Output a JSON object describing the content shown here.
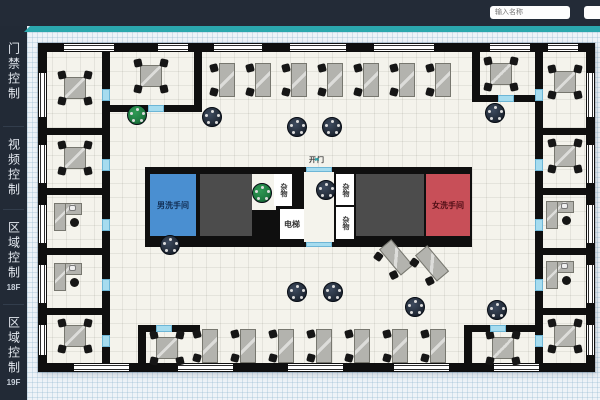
{
  "header": {
    "inputs": [
      {
        "name": "search",
        "placeholder": "输入名称"
      },
      {
        "name": "secondary",
        "placeholder": ""
      }
    ]
  },
  "sidebar": {
    "items": [
      {
        "label": "门禁控制",
        "sub": "",
        "top": 42
      },
      {
        "label": "视频控制",
        "sub": "",
        "top": 138
      },
      {
        "label": "区域控制",
        "sub": "18F",
        "top": 221
      },
      {
        "label": "区域控制",
        "sub": "19F",
        "top": 316
      }
    ]
  },
  "plan": {
    "colors": {
      "wall": "#0f0f0f",
      "floor": "#f4f3ec",
      "men": "#4a8fd1",
      "women": "#c84f58",
      "dark_room": "#4c4c4c",
      "door": "#a6dcef",
      "desk": "#b3b3ae",
      "chair": "#161616",
      "table_dark": "#232c39",
      "table_green": "#1e7a40",
      "accent": "#2ba7ad"
    },
    "door_sign": {
      "left_arrow": "◄",
      "label": "开门",
      "right_arrow": "►",
      "x": 244,
      "y": 111,
      "w": 70,
      "h": 11
    },
    "core": {
      "x": 107,
      "y": 124,
      "w": 327,
      "h": 80
    },
    "rooms": [
      {
        "name": "men-restroom",
        "label": "男洗手间",
        "x": 112,
        "y": 131,
        "w": 46,
        "h": 62,
        "bg": "men",
        "label_color": "#102c52"
      },
      {
        "name": "dark-room-left",
        "label": "",
        "x": 162,
        "y": 131,
        "w": 52,
        "h": 62,
        "bg": "dark_room"
      },
      {
        "name": "alcove",
        "label": "",
        "x": 214,
        "y": 131,
        "w": 24,
        "h": 36,
        "bg": "floor"
      },
      {
        "name": "storage-a",
        "label": "杂物",
        "x": 236,
        "y": 131,
        "w": 18,
        "h": 32,
        "bg": "#ffffff",
        "vertical": true,
        "label_color": "#333333"
      },
      {
        "name": "elevator",
        "label": "电梯",
        "x": 242,
        "y": 166,
        "w": 24,
        "h": 30,
        "bg": "#ffffff",
        "label_color": "#333333"
      },
      {
        "name": "lobby",
        "label": "",
        "x": 266,
        "y": 129,
        "w": 30,
        "h": 70,
        "bg": "floor"
      },
      {
        "name": "storage-b",
        "label": "杂物",
        "x": 298,
        "y": 131,
        "w": 18,
        "h": 31,
        "bg": "#ffffff",
        "vertical": true,
        "label_color": "#333333"
      },
      {
        "name": "storage-c",
        "label": "杂物",
        "x": 298,
        "y": 164,
        "w": 18,
        "h": 32,
        "bg": "#ffffff",
        "vertical": true,
        "label_color": "#333333"
      },
      {
        "name": "dark-room-right",
        "label": "",
        "x": 318,
        "y": 131,
        "w": 68,
        "h": 62,
        "bg": "dark_room"
      },
      {
        "name": "women-restroom",
        "label": "女洗手间",
        "x": 388,
        "y": 131,
        "w": 44,
        "h": 62,
        "bg": "women",
        "label_color": "#4e0d14"
      }
    ],
    "walls": [
      [
        0,
        0,
        557,
        9
      ],
      [
        0,
        320,
        557,
        9
      ],
      [
        0,
        0,
        9,
        329
      ],
      [
        548,
        0,
        9,
        329
      ],
      [
        64,
        9,
        8,
        311
      ],
      [
        497,
        9,
        8,
        311
      ],
      [
        9,
        85,
        55,
        7
      ],
      [
        9,
        145,
        55,
        7
      ],
      [
        9,
        205,
        55,
        7
      ],
      [
        9,
        265,
        55,
        7
      ],
      [
        505,
        85,
        43,
        7
      ],
      [
        505,
        145,
        43,
        7
      ],
      [
        505,
        205,
        43,
        7
      ],
      [
        505,
        265,
        43,
        7
      ],
      [
        156,
        9,
        8,
        60
      ],
      [
        72,
        62,
        92,
        7
      ],
      [
        434,
        9,
        8,
        50
      ],
      [
        434,
        52,
        71,
        7
      ],
      [
        100,
        282,
        8,
        38
      ],
      [
        100,
        282,
        62,
        7
      ],
      [
        426,
        282,
        8,
        38
      ],
      [
        426,
        282,
        79,
        7
      ]
    ],
    "windows": [
      [
        26,
        1,
        50,
        7,
        "h"
      ],
      [
        120,
        1,
        30,
        7,
        "h"
      ],
      [
        176,
        1,
        48,
        7,
        "h"
      ],
      [
        252,
        1,
        56,
        7,
        "h"
      ],
      [
        336,
        1,
        60,
        7,
        "h"
      ],
      [
        452,
        1,
        40,
        7,
        "h"
      ],
      [
        510,
        1,
        30,
        7,
        "h"
      ],
      [
        36,
        321,
        55,
        7,
        "h"
      ],
      [
        140,
        321,
        55,
        7,
        "h"
      ],
      [
        250,
        321,
        55,
        7,
        "h"
      ],
      [
        356,
        321,
        55,
        7,
        "h"
      ],
      [
        456,
        321,
        45,
        7,
        "h"
      ],
      [
        1,
        30,
        7,
        44,
        "v"
      ],
      [
        1,
        102,
        7,
        38,
        "v"
      ],
      [
        1,
        162,
        7,
        38,
        "v"
      ],
      [
        1,
        222,
        7,
        38,
        "v"
      ],
      [
        1,
        282,
        7,
        30,
        "v"
      ],
      [
        549,
        30,
        7,
        44,
        "v"
      ],
      [
        549,
        102,
        7,
        38,
        "v"
      ],
      [
        549,
        162,
        7,
        38,
        "v"
      ],
      [
        549,
        222,
        7,
        38,
        "v"
      ],
      [
        549,
        282,
        7,
        30,
        "v"
      ]
    ],
    "doors": [
      [
        64,
        46,
        8,
        12
      ],
      [
        64,
        116,
        8,
        12
      ],
      [
        64,
        176,
        8,
        12
      ],
      [
        64,
        236,
        8,
        12
      ],
      [
        64,
        292,
        8,
        12
      ],
      [
        497,
        46,
        8,
        12
      ],
      [
        497,
        116,
        8,
        12
      ],
      [
        497,
        176,
        8,
        12
      ],
      [
        497,
        236,
        8,
        12
      ],
      [
        497,
        292,
        8,
        12
      ],
      [
        110,
        62,
        16,
        7
      ],
      [
        460,
        52,
        16,
        7
      ],
      [
        118,
        282,
        16,
        7
      ],
      [
        452,
        282,
        16,
        7
      ],
      [
        268,
        124,
        26,
        5
      ],
      [
        268,
        199,
        26,
        5
      ]
    ],
    "furniture": {
      "desk4": [
        [
          20,
          28
        ],
        [
          20,
          98
        ],
        [
          20,
          276
        ],
        [
          96,
          16
        ],
        [
          446,
          14
        ],
        [
          510,
          22
        ],
        [
          510,
          96
        ],
        [
          510,
          276
        ],
        [
          112,
          288
        ],
        [
          448,
          288
        ]
      ],
      "exec": [
        [
          14,
          158
        ],
        [
          14,
          218
        ],
        [
          506,
          156
        ],
        [
          506,
          216
        ]
      ],
      "deskv": [
        [
          172,
          18
        ],
        [
          208,
          18
        ],
        [
          244,
          18
        ],
        [
          280,
          18
        ],
        [
          316,
          18
        ],
        [
          352,
          18
        ],
        [
          388,
          18
        ],
        [
          155,
          284
        ],
        [
          193,
          284
        ],
        [
          231,
          284
        ],
        [
          269,
          284
        ],
        [
          307,
          284
        ],
        [
          345,
          284
        ],
        [
          383,
          284
        ]
      ],
      "deskv_rot": [
        [
          342,
          198,
          -40
        ],
        [
          378,
          204,
          -40
        ]
      ],
      "round_dark": [
        [
          164,
          64
        ],
        [
          249,
          74
        ],
        [
          284,
          74
        ],
        [
          447,
          60
        ],
        [
          278,
          137
        ],
        [
          122,
          192
        ],
        [
          449,
          257
        ],
        [
          249,
          239
        ],
        [
          285,
          239
        ],
        [
          367,
          254
        ]
      ],
      "round_green": [
        [
          89,
          62
        ],
        [
          214,
          140
        ]
      ]
    }
  }
}
